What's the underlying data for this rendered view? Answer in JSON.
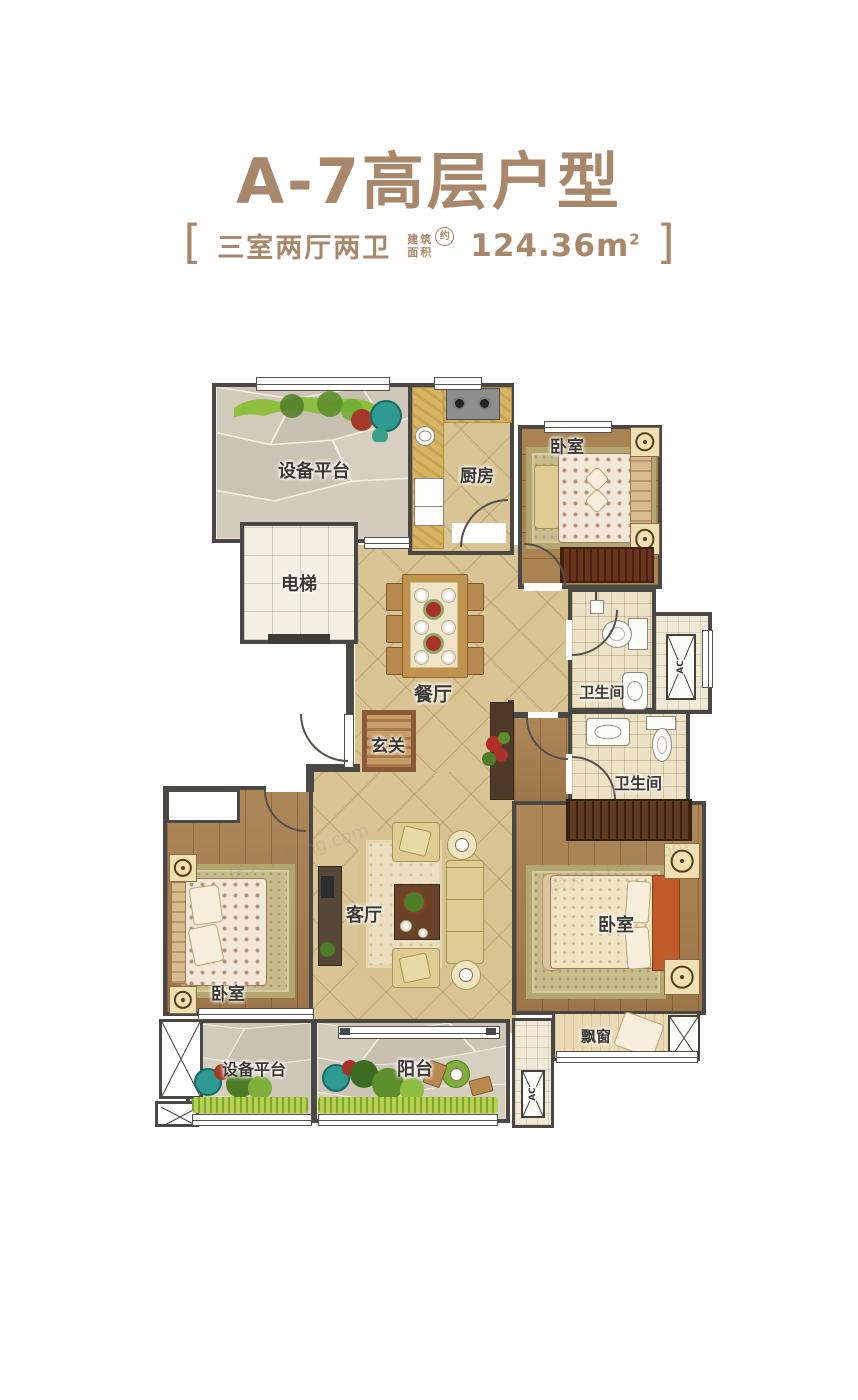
{
  "meta": {
    "accent_color": "#a8876a",
    "wall_color": "#4a4844",
    "tile_floor_color": "#d9c494",
    "wood_floor_color": "#a9804f",
    "bath_floor_color": "#ece2c6",
    "platform_floor_color": "#cec6b7"
  },
  "header": {
    "title": "A-7高层户型",
    "bracket_left": "[",
    "bracket_right": "]",
    "layout_label": "三室两厅两卫",
    "area_label_line1": "建筑",
    "area_label_line2": "面积",
    "area_approx": "约",
    "area_value": "124.36",
    "area_unit": "m",
    "area_unit_sup": "2"
  },
  "floorplan": {
    "watermark": "房天下 Fang.com",
    "labels": {
      "equipment_platform_top": "设备平台",
      "kitchen": "厨房",
      "bedroom_top": "卧室",
      "elevator": "电梯",
      "dining_room": "餐厅",
      "bathroom_1": "卫生间",
      "bathroom_2": "卫生间",
      "foyer": "玄关",
      "living_room": "客厅",
      "bedroom_left": "卧室",
      "bedroom_master": "卧室",
      "bay_window": "飘窗",
      "equipment_platform_bottom": "设备平台",
      "balcony": "阳台",
      "ac_marker_1": "AC",
      "ac_marker_2": "AC"
    }
  }
}
